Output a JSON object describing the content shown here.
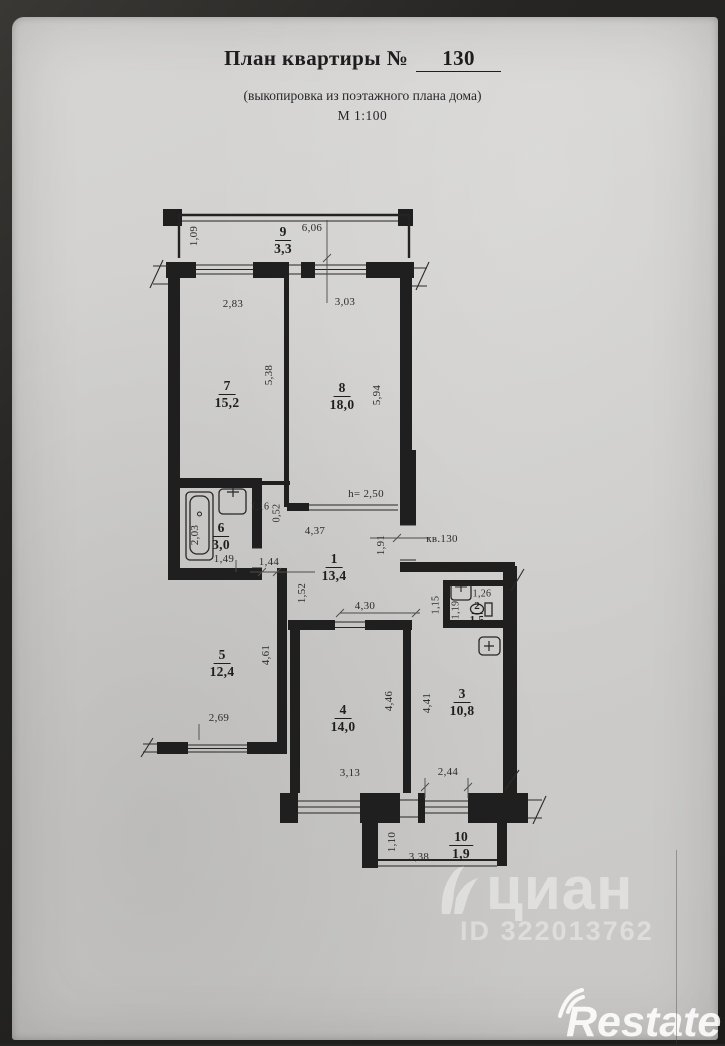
{
  "header": {
    "title": "План квартиры №",
    "number": "130",
    "subtitle": "(выкопировка из поэтажного плана дома)",
    "scale": "М 1:100"
  },
  "rooms": [
    {
      "number": "9",
      "area": "3,3"
    },
    {
      "number": "7",
      "area": "15,2"
    },
    {
      "number": "8",
      "area": "18,0"
    },
    {
      "number": "6",
      "area": "3,0"
    },
    {
      "number": "1",
      "area": "13,4"
    },
    {
      "number": "2",
      "area": "1,5"
    },
    {
      "number": "5",
      "area": "12,4"
    },
    {
      "number": "4",
      "area": "14,0"
    },
    {
      "number": "3",
      "area": "10,8"
    },
    {
      "number": "10",
      "area": "1,9"
    }
  ],
  "dims": {
    "balcony_top_depth": "1,09",
    "balcony_top_width": "6,06",
    "room7_width": "2,83",
    "room8_width": "3,03",
    "room7_depth": "5,38",
    "room8_depth": "5,94",
    "bath_niche_width": "1,16",
    "bath_niche_depth": "0,52",
    "bath_length": "2,03",
    "bath_width": "1,49",
    "hall_width_top": "4,37",
    "door_height_note": "h= 2,50",
    "entry_opening": "1,91",
    "apt_label": "кв.130",
    "room5_door_opening": "1,44",
    "hall_left_depth": "1,52",
    "hall_width_bottom": "4,30",
    "wc_duct_depth": "1,15",
    "wc_depth": "1,19",
    "wc_width": "1,26",
    "room5_depth": "4,61",
    "room5_width": "2,69",
    "room4_depth": "4,46",
    "room3_depth": "4,41",
    "room4_width": "3,13",
    "room3_width": "2,44",
    "balcony_bottom_depth": "1,10",
    "balcony_bottom_width": "3,38"
  },
  "watermarks": {
    "listing_logo": "циан",
    "listing_id": "ID 322013762",
    "agency": "Restate"
  }
}
